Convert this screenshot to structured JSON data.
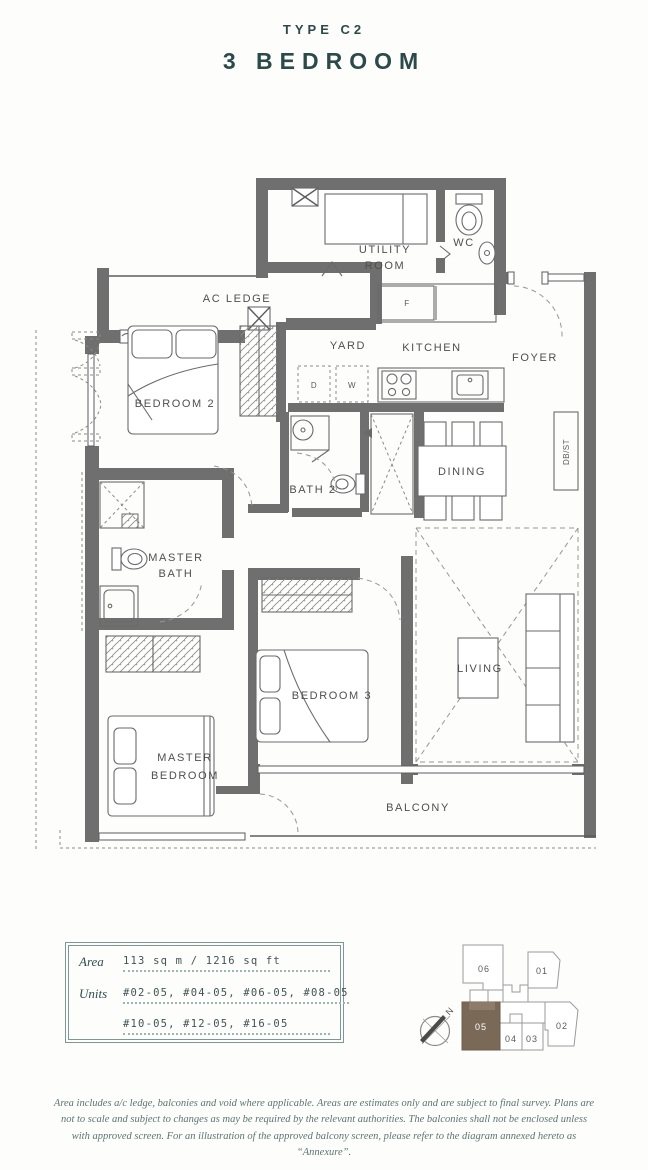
{
  "header": {
    "type_label": "TYPE C2",
    "title": "3 BEDROOM"
  },
  "plan": {
    "labels": {
      "ac_ledge": "AC LEDGE",
      "utility_1": "UTILITY",
      "utility_2": "ROOM",
      "wc": "WC",
      "yard": "YARD",
      "kitchen": "KITCHEN",
      "foyer": "FOYER",
      "bedroom2": "BEDROOM 2",
      "bath2": "BATH 2",
      "dining": "DINING",
      "dbst": "DB/ST",
      "master_bath_1": "MASTER",
      "master_bath_2": "BATH",
      "bedroom3": "BEDROOM 3",
      "living": "LIVING",
      "master_bedroom_1": "MASTER",
      "master_bedroom_2": "BEDROOM",
      "balcony": "BALCONY"
    },
    "appliances": {
      "fridge": "F",
      "dryer": "D",
      "washer": "W"
    }
  },
  "info_box": {
    "area_label": "Area",
    "area_value": "113 sq m / 1216 sq ft",
    "units_label": "Units",
    "units_line1": "#02-05, #04-05, #06-05, #08-05",
    "units_line2": "#10-05, #12-05, #16-05"
  },
  "unit_locator": {
    "units": {
      "u06": "06",
      "u01": "01",
      "u05": "05",
      "u04": "04",
      "u03": "03",
      "u02": "02"
    },
    "highlighted_unit": "05",
    "compass_label": "N"
  },
  "footer": {
    "disclaimer": "Area includes a/c ledge, balconies and void where applicable. Areas are estimates only and are subject to final survey. Plans are not to scale and subject to changes as may be required by the relevant authorities. The balconies shall not be enclosed unless with approved screen. For an illustration of the approved balcony screen, please refer to the diagram annexed hereto as “Annexure”."
  },
  "colors": {
    "title": "#2b4a49",
    "wall": "#6f6f6f",
    "highlight_brown": "#7b6958",
    "footer_text": "#5c7474"
  }
}
